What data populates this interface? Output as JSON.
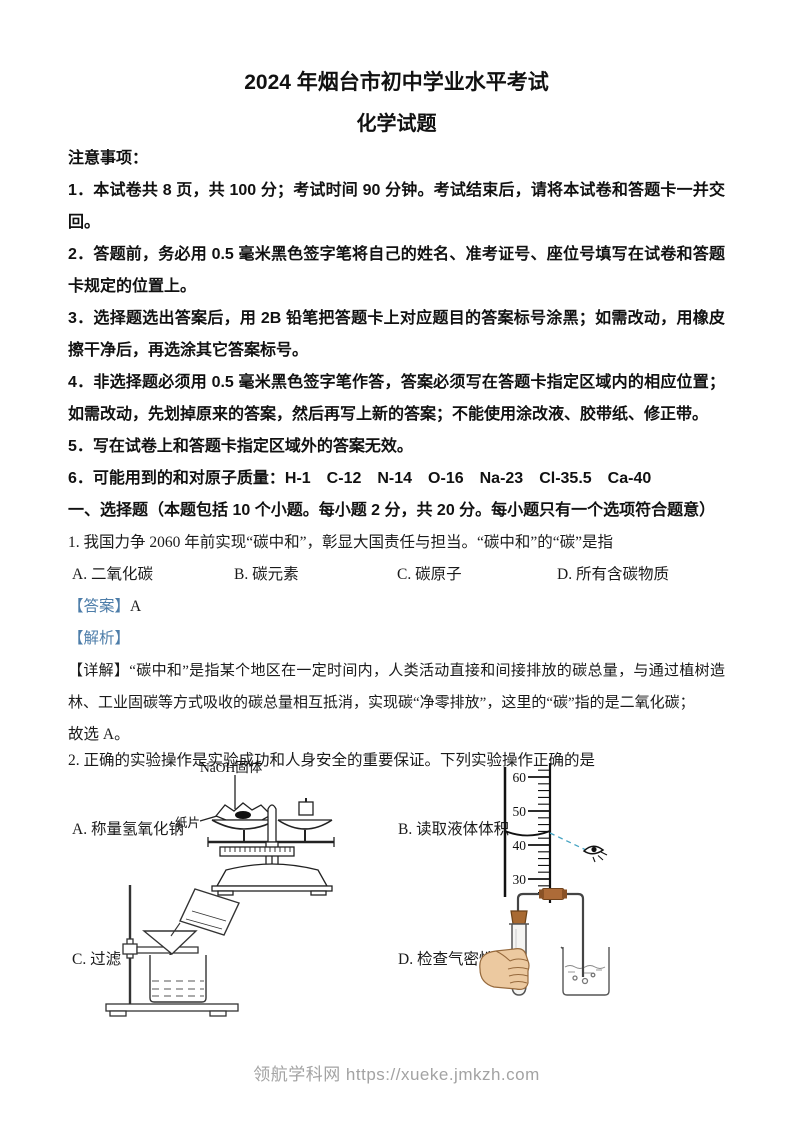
{
  "page": {
    "title": "2024 年烟台市初中学业水平考试",
    "subtitle": "化学试题",
    "watermark": "领航学科网 https://xueke.jmkzh.com"
  },
  "colors": {
    "answer_label_blue": "#4d7da9",
    "sight_line_teal": "#45a3c2",
    "stopper_brown": "#a86a32",
    "hand_skin": "#ecc9a0",
    "watermark_gray": "#a3a3a3"
  },
  "notice": {
    "heading": "注意事项：",
    "items": [
      "1．本试卷共 8 页，共 100 分；考试时间 90 分钟。考试结束后，请将本试卷和答题卡一并交回。",
      "2．答题前，务必用 0.5 毫米黑色签字笔将自己的姓名、准考证号、座位号填写在试卷和答题卡规定的位置上。",
      "3．选择题选出答案后，用 2B 铅笔把答题卡上对应题目的答案标号涂黑；如需改动，用橡皮擦干净后，再选涂其它答案标号。",
      "4．非选择题必须用 0.5 毫米黑色签字笔作答，答案必须写在答题卡指定区域内的相应位置；如需改动，先划掉原来的答案，然后再写上新的答案；不能使用涂改液、胶带纸、修正带。",
      "5．写在试卷上和答题卡指定区域外的答案无效。",
      "6．可能用到的和对原子质量：H-1　C-12　N-14　O-16　Na-23　Cl-35.5　Ca-40"
    ]
  },
  "section1": {
    "heading": "一、选择题（本题包括 10 个小题。每小题 2 分，共 20 分。每小题只有一个选项符合题意）"
  },
  "q1": {
    "stem": "1. 我国力争 2060 年前实现“碳中和”，彰显大国责任与担当。“碳中和”的“碳”是指",
    "options": [
      "A. 二氧化碳",
      "B. 碳元素",
      "C. 碳原子",
      "D. 所有含碳物质"
    ],
    "answer_label": "【答案】",
    "answer_value": "A",
    "analysis_label": "【解析】",
    "detail": "【详解】“碳中和”是指某个地区在一定时间内，人类活动直接和间接排放的碳总量，与通过植树造林、工业固碳等方式吸收的碳总量相互抵消，实现碳“净零排放”，这里的“碳”指的是二氧化碳；",
    "conclusion": "故选 A。"
  },
  "q2": {
    "stem": "2. 正确的实验操作是实验成功和人身安全的重要保证。下列实验操作正确的是",
    "options": [
      {
        "label": "A. 称量氢氧化钠"
      },
      {
        "label": "B. 读取液体体积"
      },
      {
        "label": "C. 过滤"
      },
      {
        "label": "D. 检查气密性"
      }
    ],
    "diagrams": {
      "balance": {
        "naoh_label": "NaOH固体",
        "paper_label": "纸片"
      },
      "cylinder": {
        "ticks": [
          "60",
          "50",
          "40",
          "30"
        ]
      }
    }
  }
}
